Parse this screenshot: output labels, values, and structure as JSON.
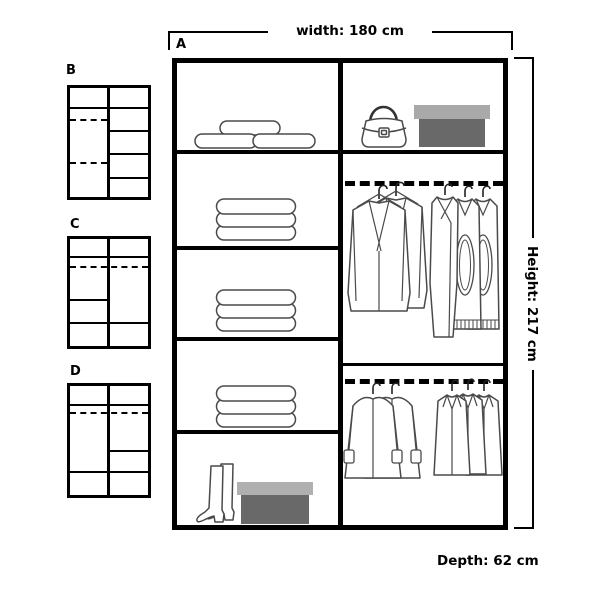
{
  "diagram": {
    "type": "wardrobe-interior-layout",
    "dimensions": {
      "width_label": "width: 180 cm",
      "height_label": "Height: 217 cm",
      "depth_label": "Depth: 62 cm"
    },
    "main_layout": {
      "label": "A",
      "left_column": [
        "stacked-pillows",
        "folded-towels",
        "folded-towels",
        "folded-towels",
        "boots-and-shoe-box"
      ],
      "right_column": [
        "handbag-and-shoe-box",
        "hanging-rail-jackets-sweaters",
        "hanging-rail-coats"
      ]
    },
    "alternative_layouts": [
      {
        "label": "B",
        "description": "left column two hanging rails, right column five shelves"
      },
      {
        "label": "C",
        "description": "full-width top shelf and rail, left half shelf, bottom shelf row"
      },
      {
        "label": "D",
        "description": "full-width top shelf and rail, right half shelf, bottom shelf row"
      }
    ]
  },
  "icons": {
    "top_left": "pillows-icon",
    "top_right_bag": "handbag-icon",
    "top_right_box": "shoe-box-icon",
    "shelves": "folded-towels-icon",
    "bottom_boots": "boots-icon",
    "bottom_box": "shoe-box-icon",
    "upper_rail_left": "jackets-icon",
    "upper_rail_right": "sweaters-icon",
    "lower_rail_left": "fur-coats-icon",
    "lower_rail_right": "coats-icon"
  },
  "colors": {
    "frame": "#000000",
    "item_outline": "#4a4a4a",
    "box_lid": "#a9a9a9",
    "box_lid_light": "#b0b0b0",
    "box_base": "#696969",
    "background": "#ffffff"
  }
}
